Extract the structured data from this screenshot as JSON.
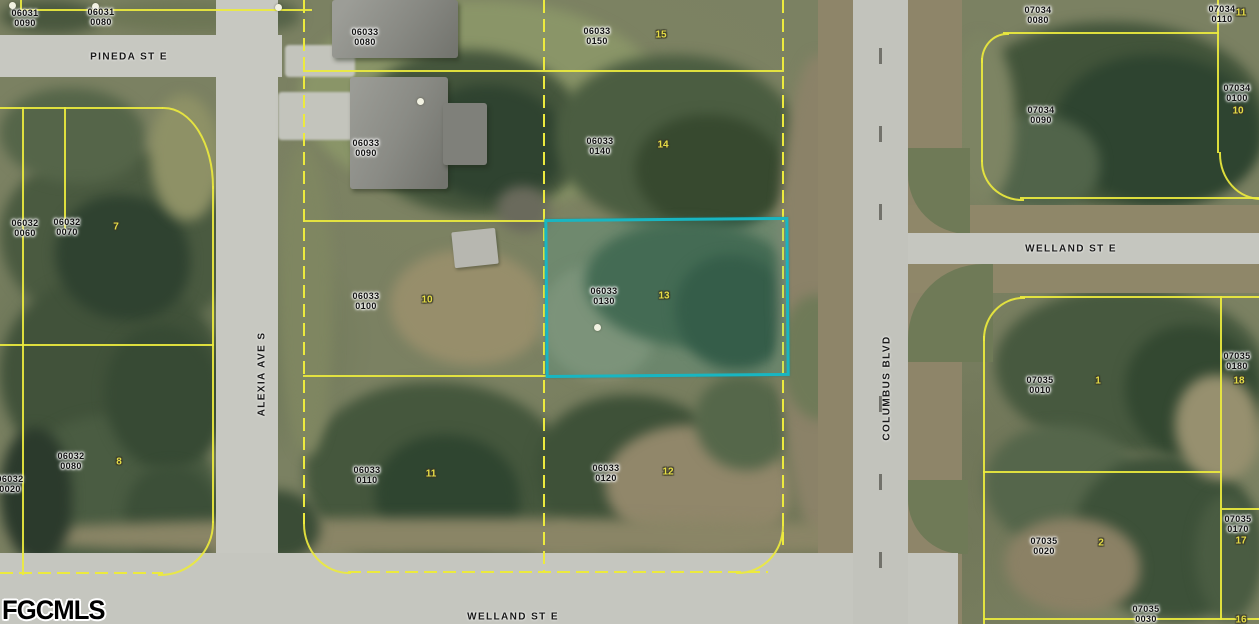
{
  "map": {
    "description": "Aerial parcel map with highlighted lot",
    "watermark": "FGCMLS",
    "highlighted_parcel": {
      "id": "06033 0130",
      "lot_marker": "13",
      "outline_color": "#18b6c2"
    },
    "streets": [
      {
        "name": "pineda-st-e",
        "label": "PINEDA ST E",
        "x": 129,
        "y": 57,
        "rotate": 0
      },
      {
        "name": "alexia-ave-s",
        "label": "ALEXIA AVE S",
        "x": 262,
        "y": 374,
        "rotate": -90
      },
      {
        "name": "columbus-blvd",
        "label": "COLUMBUS BLVD",
        "x": 887,
        "y": 388,
        "rotate": -90
      },
      {
        "name": "welland-st-e-east",
        "label": "WELLAND ST E",
        "x": 1071,
        "y": 249,
        "rotate": 0
      },
      {
        "name": "welland-st-e-south",
        "label": "WELLAND ST E",
        "x": 513,
        "y": 617,
        "rotate": 0
      }
    ],
    "parcels": [
      {
        "line1": "06031",
        "line2": "0090",
        "x": 25,
        "y": 18
      },
      {
        "line1": "06031",
        "line2": "0080",
        "x": 101,
        "y": 17
      },
      {
        "line1": "06033",
        "line2": "0080",
        "x": 365,
        "y": 37
      },
      {
        "line1": "06033",
        "line2": "0090",
        "x": 366,
        "y": 148
      },
      {
        "line1": "06033",
        "line2": "0100",
        "x": 366,
        "y": 301,
        "marker": "10",
        "mx": 427,
        "my": 300
      },
      {
        "line1": "06033",
        "line2": "0110",
        "x": 367,
        "y": 475,
        "marker": "11",
        "mx": 431,
        "my": 474
      },
      {
        "line1": "06033",
        "line2": "0150",
        "x": 597,
        "y": 36,
        "marker": "15",
        "mx": 661,
        "my": 35
      },
      {
        "line1": "06033",
        "line2": "0140",
        "x": 600,
        "y": 146,
        "marker": "14",
        "mx": 663,
        "my": 145
      },
      {
        "line1": "06033",
        "line2": "0130",
        "x": 604,
        "y": 296,
        "marker": "13",
        "mx": 664,
        "my": 296
      },
      {
        "line1": "06033",
        "line2": "0120",
        "x": 606,
        "y": 473,
        "marker": "12",
        "mx": 668,
        "my": 472
      },
      {
        "line1": "06032",
        "line2": "0060",
        "x": 25,
        "y": 228
      },
      {
        "line1": "06032",
        "line2": "0070",
        "x": 67,
        "y": 227,
        "marker": "7",
        "mx": 116,
        "my": 227
      },
      {
        "line1": "06032",
        "line2": "0080",
        "x": 71,
        "y": 461,
        "marker": "8",
        "mx": 119,
        "my": 462
      },
      {
        "line1": "06032",
        "line2": "0020",
        "x": 10,
        "y": 484
      },
      {
        "line1": "07034",
        "line2": "0080",
        "x": 1038,
        "y": 15
      },
      {
        "line1": "07034",
        "line2": "0110",
        "x": 1222,
        "y": 14,
        "marker": "11",
        "mx": 1241,
        "my": 13
      },
      {
        "line1": "07034",
        "line2": "0090",
        "x": 1041,
        "y": 115
      },
      {
        "line1": "07034",
        "line2": "0100",
        "x": 1237,
        "y": 93,
        "marker": "10",
        "mx": 1238,
        "my": 111
      },
      {
        "line1": "07035",
        "line2": "0010",
        "x": 1040,
        "y": 385,
        "marker": "1",
        "mx": 1098,
        "my": 381
      },
      {
        "line1": "07035",
        "line2": "0180",
        "x": 1237,
        "y": 361,
        "marker": "18",
        "mx": 1239,
        "my": 381
      },
      {
        "line1": "07035",
        "line2": "0020",
        "x": 1044,
        "y": 546,
        "marker": "2",
        "mx": 1101,
        "my": 543
      },
      {
        "line1": "07035",
        "line2": "0170",
        "x": 1238,
        "y": 524,
        "marker": "17",
        "mx": 1241,
        "my": 541
      },
      {
        "line1": "07035",
        "line2": "0030",
        "x": 1146,
        "y": 614,
        "marker": "16",
        "mx": 1241,
        "my": 620
      }
    ]
  }
}
